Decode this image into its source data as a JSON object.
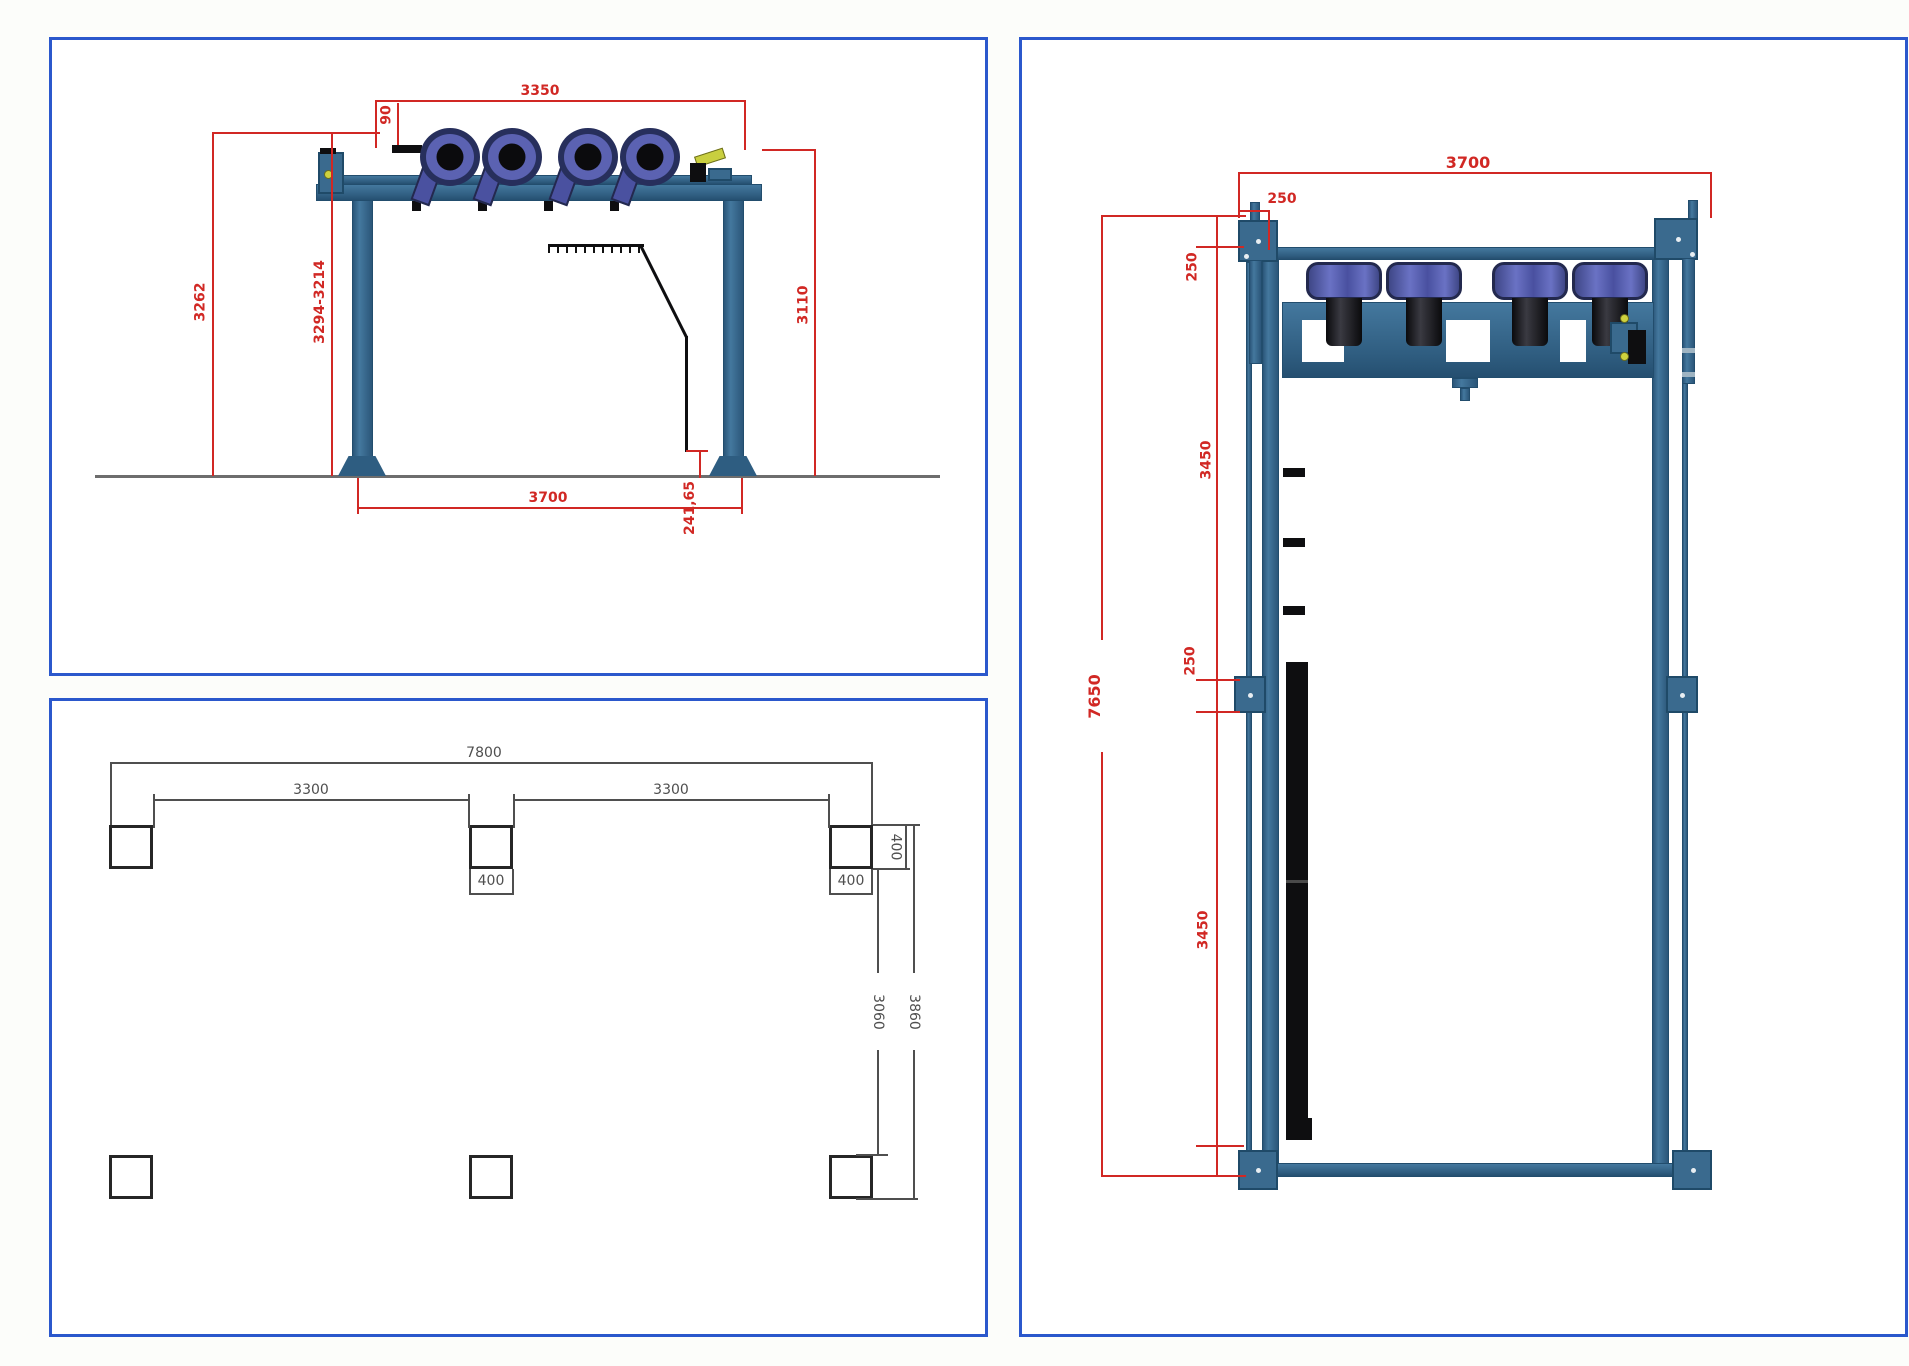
{
  "drawing": {
    "colors": {
      "dimension_red": "#d12824",
      "dimension_gray": "#4f4f4f",
      "frame_steel_blue": "#3a6a8e",
      "fan_purple": "#5b62b2",
      "panel_border_blue": "#2b58cc"
    },
    "views": {
      "front": {
        "dims": {
          "top_width": "3350",
          "nozzle_offset": "90",
          "height_left": "3262",
          "height_range": "3294-3214",
          "height_right": "3110",
          "base_width": "3700",
          "hose_clearance": "241,65"
        }
      },
      "foundation": {
        "dims": {
          "total_width": "7800",
          "bay_left": "3300",
          "bay_right": "3300",
          "pad_width_mid": "400",
          "pad_width_right": "400",
          "pad_height": "400",
          "row_clear_span": "3060",
          "row_outer_span": "3860"
        }
      },
      "plan": {
        "dims": {
          "width": "3700",
          "corner_offset": "250",
          "seg_top": "250",
          "seg_upper": "3450",
          "seg_mid": "250",
          "seg_lower": "3450",
          "total_length": "7650"
        }
      }
    }
  }
}
